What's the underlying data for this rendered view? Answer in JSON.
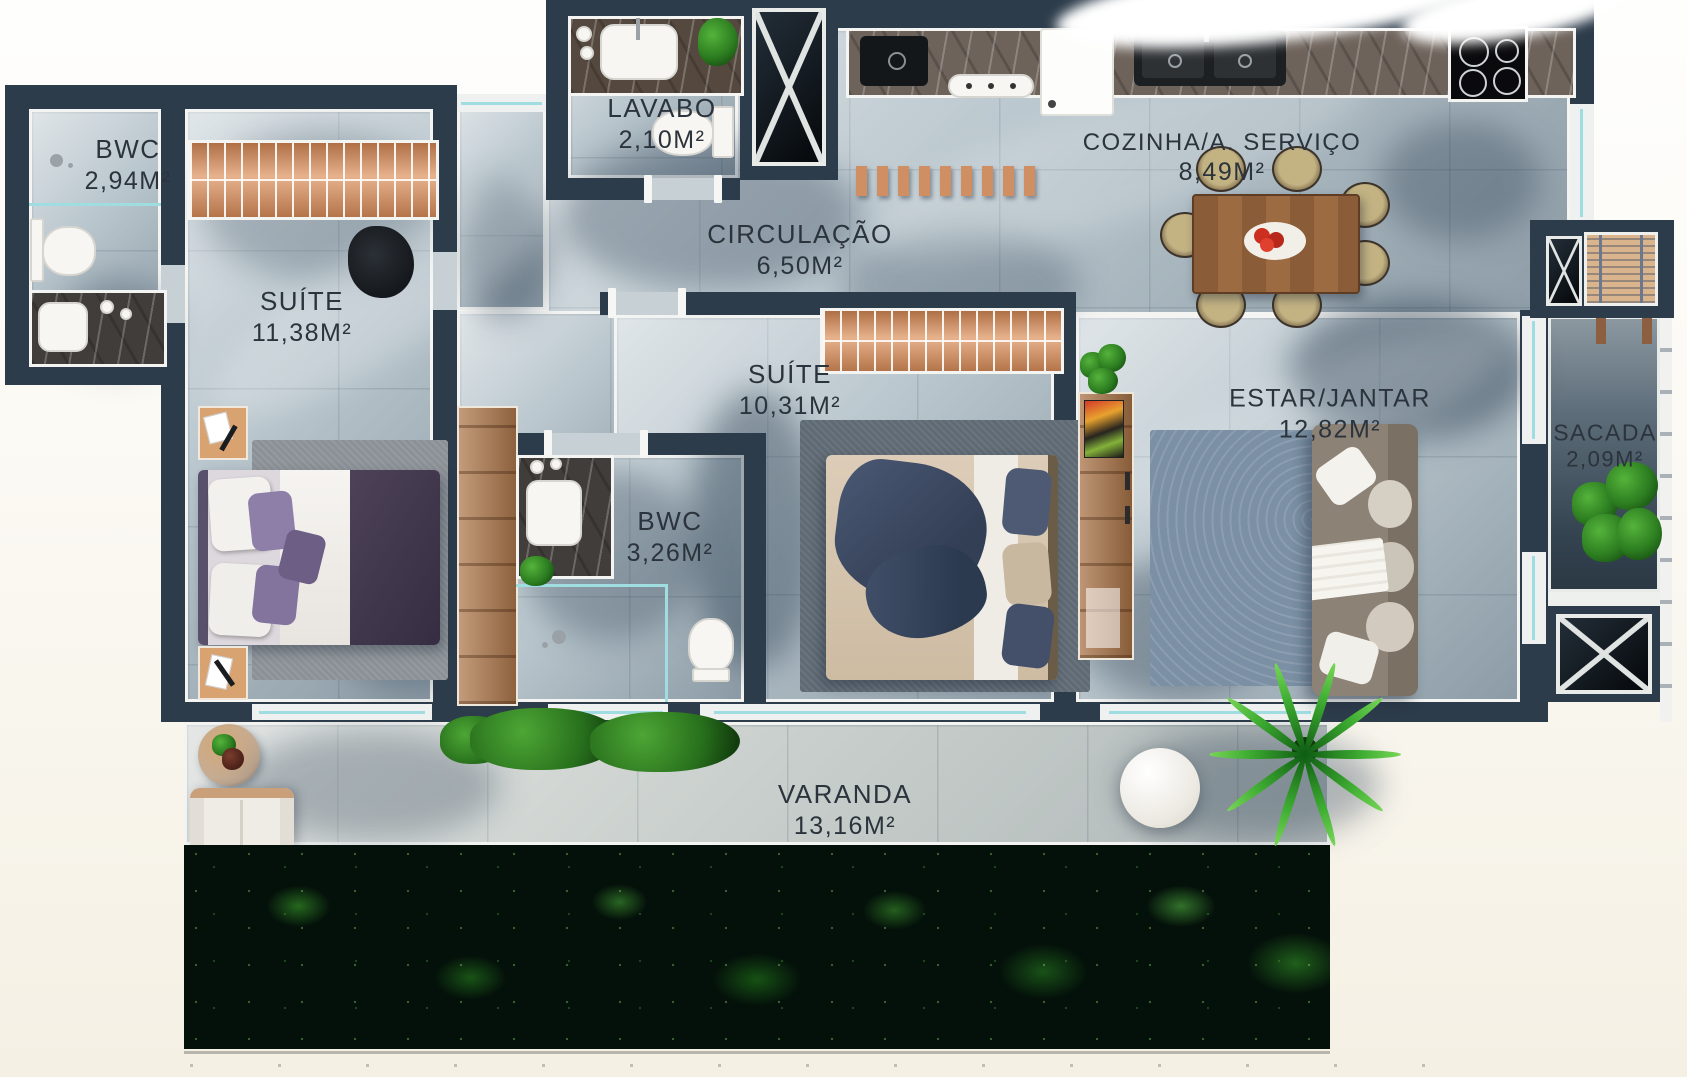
{
  "page": {
    "type": "apartment-floor-plan"
  },
  "colors": {
    "wall": "#2d3c4b",
    "floor": "#b9c6cd",
    "floor_trim": "#f4f5f3",
    "wood_closet": "#dd9a6e",
    "wood_table": "#8a5c38",
    "glass": "#9fdde0",
    "text": "#2b333c",
    "sacada_floor": "#3c4f5e",
    "hedge": "#04100a",
    "leaf": "#3fae33",
    "background": "#faf7f0"
  },
  "rooms": {
    "bwc1": {
      "name": "BWC",
      "area": "2,94M²"
    },
    "suite1": {
      "name": "SUÍTE",
      "area": "11,38M²"
    },
    "lavabo": {
      "name": "LAVABO",
      "area": "2,10M²"
    },
    "circulacao": {
      "name": "CIRCULAÇÃO",
      "area": "6,50M²"
    },
    "cozinha": {
      "name": "COZINHA/A. SERVIÇO",
      "area": "8,49M²"
    },
    "suite2": {
      "name": "SUÍTE",
      "area": "10,31M²"
    },
    "bwc2": {
      "name": "BWC",
      "area": "3,26M²"
    },
    "estar": {
      "name": "ESTAR/JANTAR",
      "area": "12,82M²"
    },
    "sacada": {
      "name": "SACADA",
      "area": "2,09M²"
    },
    "varanda": {
      "name": "VARANDA",
      "area": "13,16M²"
    }
  }
}
